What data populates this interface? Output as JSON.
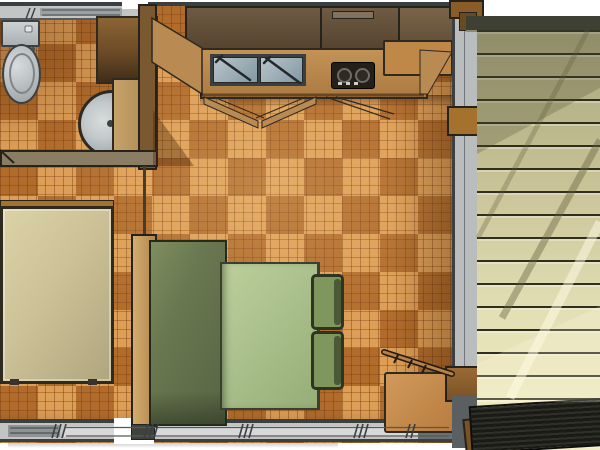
{
  "scene": {
    "description": "3D top-down floor plan rendering of a small cabin interior with a side deck; no text is visible in the image",
    "view": "top-down 3D architectural render",
    "rooms": [
      "bathroom",
      "kitchen",
      "sleeping area",
      "dining area",
      "deck"
    ]
  },
  "legend": {
    "objects": [
      "toilet",
      "round bathroom sink",
      "bathroom vanity",
      "overhead kitchen cabinets",
      "kitchen counter",
      "double-basin kitchen sink with faucets",
      "two-burner stove",
      "counter box",
      "open cabinet doors",
      "bed",
      "bench seat",
      "dining table",
      "two chairs",
      "storage box with prop stick",
      "parquet floor",
      "window walls",
      "wood threshold step",
      "deck plank flooring",
      "doormat"
    ],
    "chair_count": 2
  },
  "colors": {
    "outline": "#2e2a22",
    "wall_line": "#3a3f41",
    "wall_gray": "#c2c5c4",
    "wall_gray_dark": "#8e9394",
    "wood_wall": "#7a5930",
    "wood_trim": "#a4712f",
    "wood_post": "#b08850",
    "floor_base": "#c67f38",
    "cabinet_dark": "#55432f",
    "counter_tan": "#aa7a40",
    "box_tan": "#c08848",
    "metal": "#9aa7ae",
    "metal_light": "#d8dcdd",
    "stove_black": "#241f19",
    "bed_light": "#dcd2a8",
    "bed_dark": "#b0a67e",
    "bench_green": "#697850",
    "table_green": "#a9bf8b",
    "chair_green": "#7f965c",
    "chair_frame": "#2e3322",
    "deck_khaki": "#a9a57d",
    "deck_pale": "#f1edc4",
    "deck_gap": "#2f2f1f",
    "deck_beam": "#3f4034",
    "mat_black": "#1b1b16"
  }
}
